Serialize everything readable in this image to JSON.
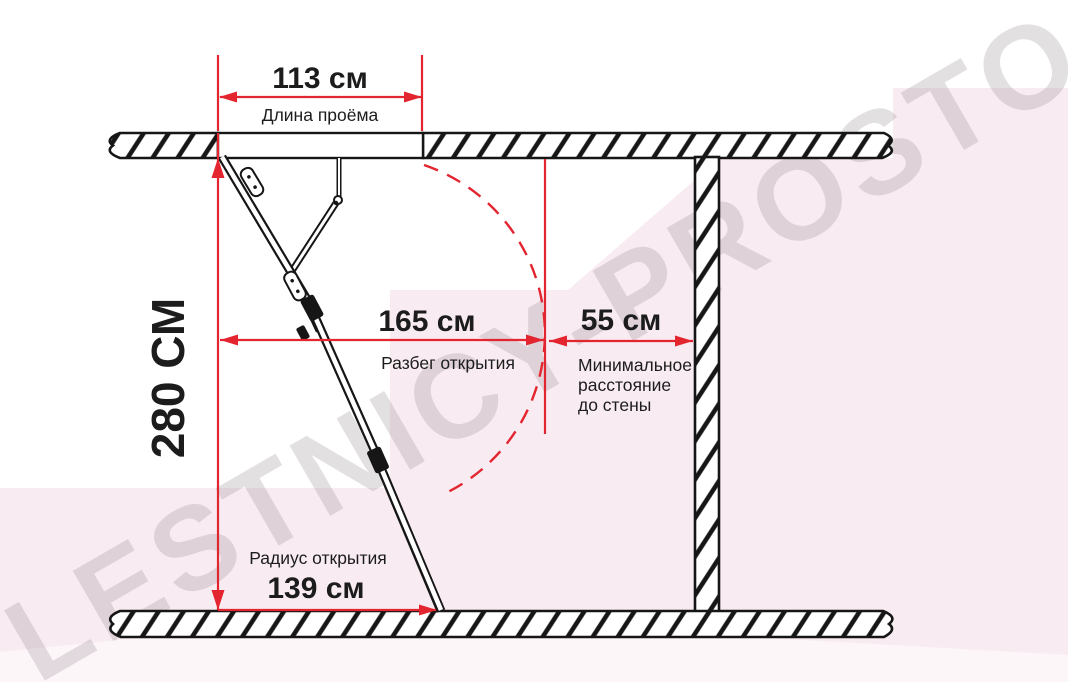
{
  "watermark": {
    "text": "LESTNICY-PROSTO.RU"
  },
  "colors": {
    "dimension_red": "#e32530",
    "drawing_ink": "#161616",
    "background_pink": "#f8ecf2",
    "watermark_gray": "#e7e1e5"
  },
  "dimensions": {
    "opening_length": {
      "value": "113 см",
      "label": "Длина проёма"
    },
    "ceiling_height": {
      "value": "280 СМ"
    },
    "opening_run": {
      "value": "165 см",
      "label": "Разбег открытия"
    },
    "wall_clearance": {
      "value": "55 см",
      "label_lines": [
        "Минимальное",
        "расстояние",
        "до стены"
      ]
    },
    "opening_radius": {
      "value": "139 см",
      "label": "Радиус открытия"
    }
  }
}
